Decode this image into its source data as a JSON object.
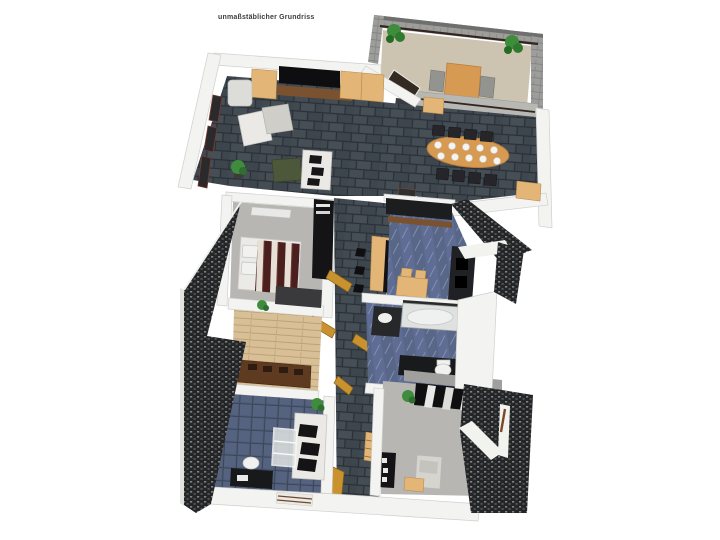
{
  "page": {
    "title": "unmaßstäblicher Grundriss",
    "background": "#ffffff"
  },
  "icons": {
    "heart": "♥"
  },
  "colors": {
    "page_bg": "#ffffff",
    "title_color": "#3c3c3c",
    "wall_white": "#f3f3f1",
    "wall_edge": "#cfcfcb",
    "wall_gray": "#9d9d9b",
    "roof_dark": "#242527",
    "tile_dark": "#424a52",
    "tile_grout": "#2a3036",
    "carpet_gray": "#b7b6b2",
    "office_blue": "#4f5c74",
    "kitchen_blue": "#5f6d94",
    "wood_floor": "#d8bf96",
    "balcony_floor": "#cdc3b1",
    "wood_light": "#e3b577",
    "wood_dark": "#7a5230",
    "wood_door": "#c8922f",
    "wood_table": "#d79a52",
    "sofa_white": "#eae9e5",
    "appliance_dark": "#1b1c1e",
    "white_fixture": "#f1f2f0",
    "green_plant": "#3e8c3c",
    "green_ottoman": "#4c5839",
    "bed_stripe_dark": "#4a1f1d",
    "bed_stripe_light": "#e6e0d6",
    "railing": "#332620"
  }
}
